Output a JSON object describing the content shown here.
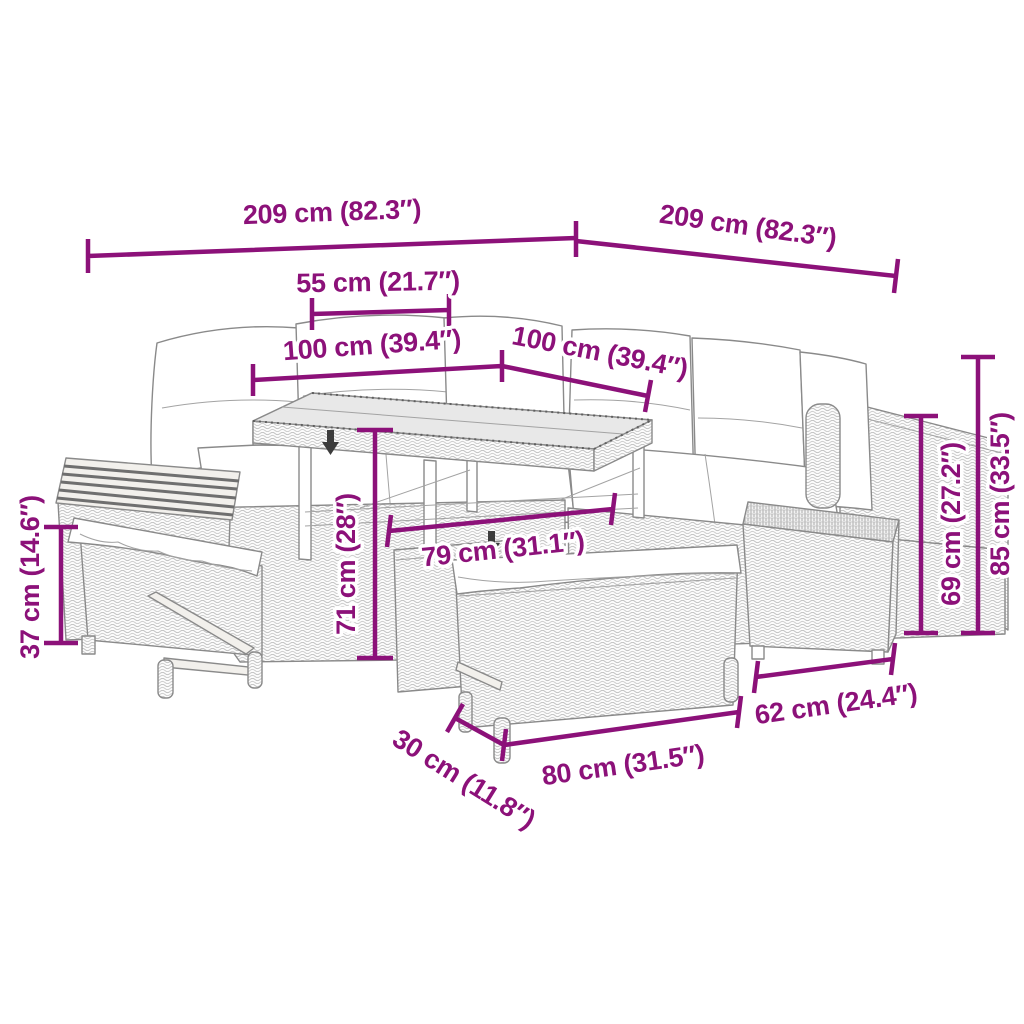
{
  "diagram": {
    "kind": "product dimension diagram",
    "subject": "poly rattan garden lounge set: corner sofa with cushions, height-adjustable dining table, two benches, wood-top side table and footstool",
    "background_color": "#ffffff",
    "accent_color": "#8C1179",
    "artwork_line_color": "#8a8a8a"
  },
  "dimensions": [
    {
      "id": "overall-width-left",
      "label": "209 cm (82.3″)"
    },
    {
      "id": "overall-width-right",
      "label": "209 cm (82.3″)"
    },
    {
      "id": "tabletop-offset",
      "label": "55 cm (21.7″)"
    },
    {
      "id": "tabletop-length-left",
      "label": "100 cm (39.4″)"
    },
    {
      "id": "tabletop-length-right",
      "label": "100 cm (39.4″)"
    },
    {
      "id": "table-height",
      "label": "71 cm (28″)"
    },
    {
      "id": "table-depth",
      "label": "79 cm (31.1″)"
    },
    {
      "id": "armrest-height",
      "label": "69 cm (27.2″)"
    },
    {
      "id": "backrest-height",
      "label": "85 cm (33.5″)"
    },
    {
      "id": "bench-height",
      "label": "37 cm (14.6″)"
    },
    {
      "id": "footstool-depth",
      "label": "62 cm (24.4″)"
    },
    {
      "id": "bench-length",
      "label": "80 cm (31.5″)"
    },
    {
      "id": "bench-depth",
      "label": "30 cm (11.8″)"
    }
  ]
}
